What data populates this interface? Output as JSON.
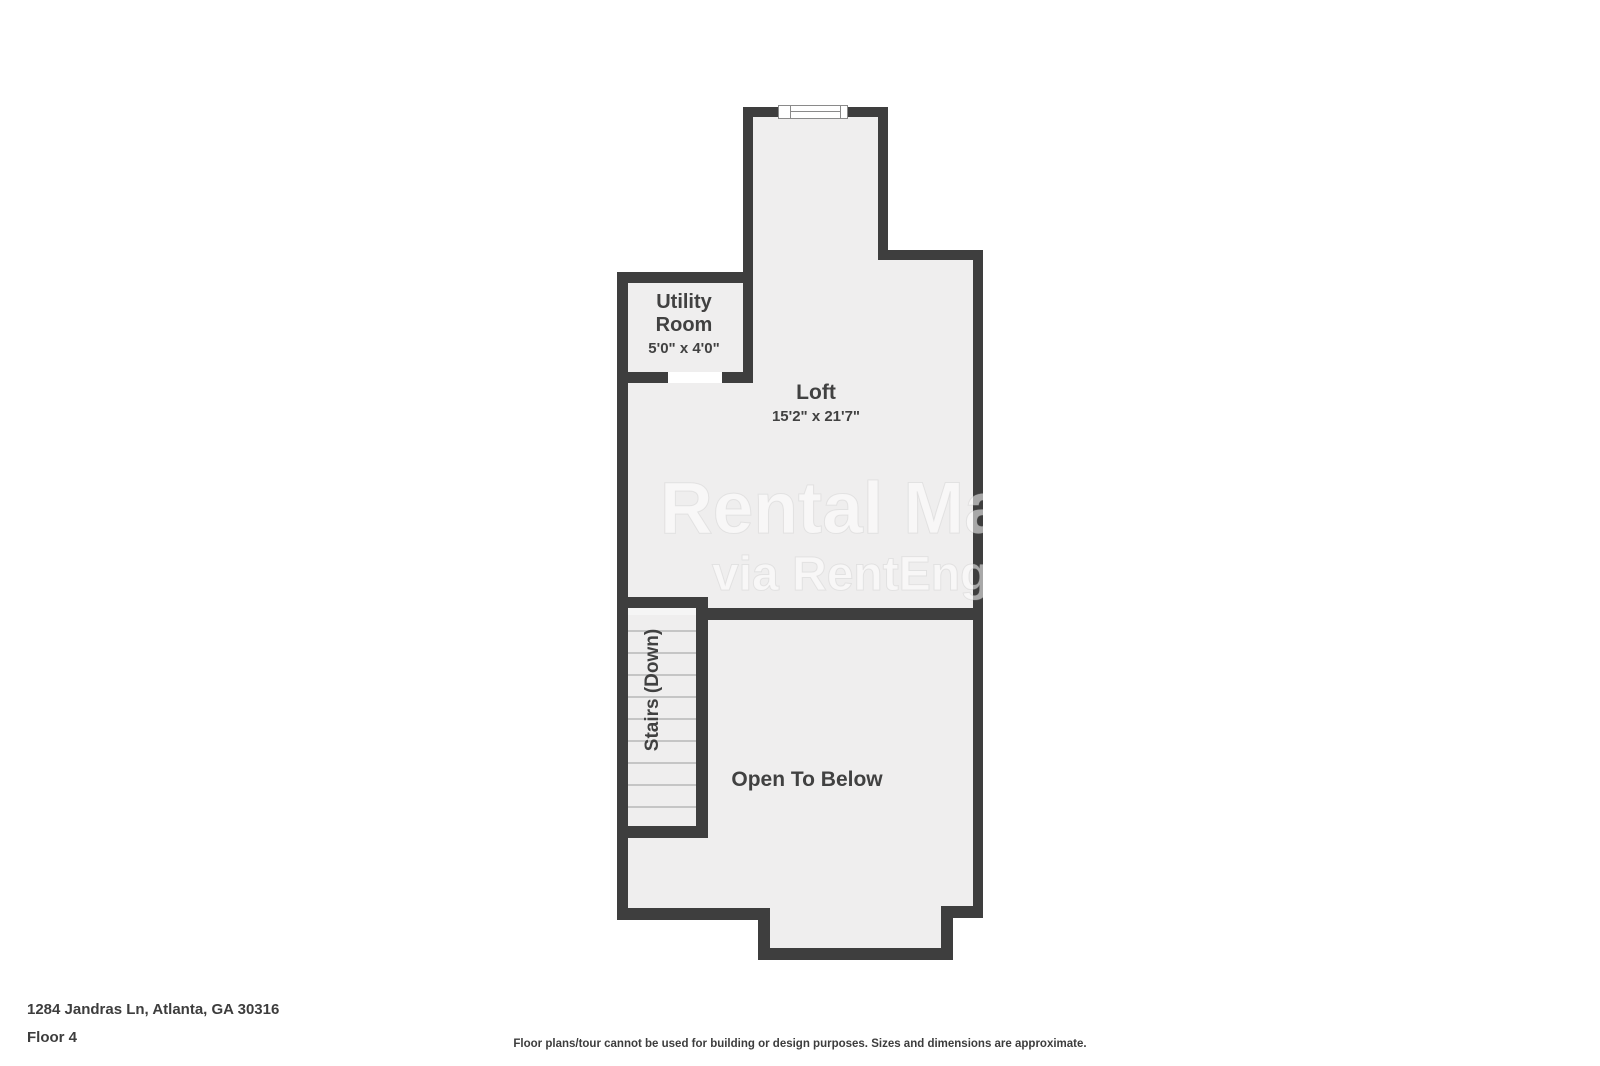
{
  "plan": {
    "rooms": {
      "utility": {
        "name": "Utility Room",
        "dimensions": "5'0\" x 4'0\""
      },
      "loft": {
        "name": "Loft",
        "dimensions": "15'2\" x 21'7\""
      },
      "stairs": {
        "label": "Stairs (Down)"
      },
      "open_to_below": {
        "label": "Open To Below"
      }
    },
    "features": {
      "top_window": "window-symbol",
      "utility_door": "door-opening"
    },
    "watermark": {
      "line1": "Rental Ma",
      "line2": "via RentEngi"
    }
  },
  "footer": {
    "address": "1284 Jandras Ln, Atlanta, GA 30316",
    "floor_label": "Floor 4",
    "disclaimer": "Floor plans/tour cannot be used for building or design purposes. Sizes and dimensions are approximate."
  },
  "colors": {
    "wall": "#3e3e3e",
    "floor_fill": "#efeeee",
    "stairs_fill": "#f5f5f5",
    "tread_line": "#c5c5c5",
    "label_text": "#414141",
    "footer_text": "#3d3d3d",
    "watermark": "rgba(255,255,255,0.55)"
  }
}
